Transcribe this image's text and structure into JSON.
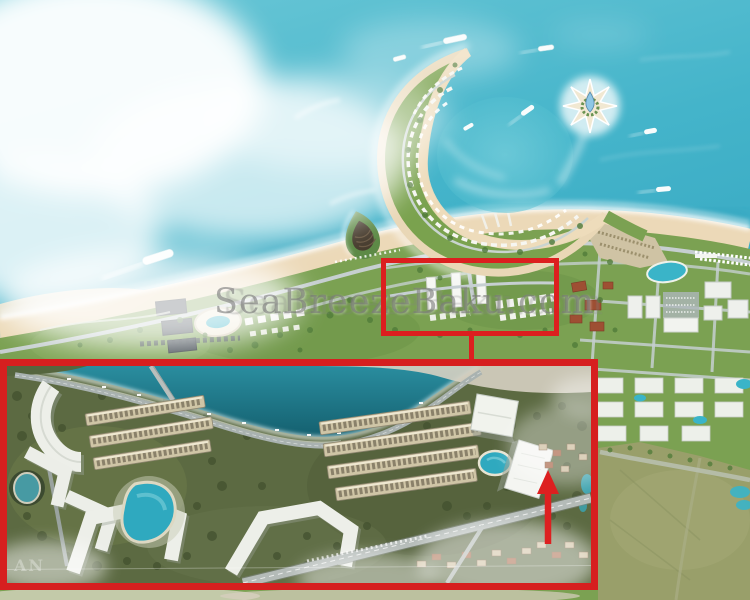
{
  "image": {
    "description": "Aerial rendering of the SeaBreeze Baku seaside resort masterplan with a crescent-shaped artificial island, a star-shaped island, beach, residential districts and a zoom inset of the highlighted coastal block",
    "watermark": {
      "text": "SeaBreezeBaku.com",
      "color": "#767676"
    },
    "annotations": {
      "highlight_box": {
        "color": "#dc1f1f",
        "purpose": "marks the coastal block that is enlarged in the inset"
      },
      "connector_line": {
        "color": "#dc1f1f"
      },
      "inset": {
        "border_color": "#d61f1f",
        "purpose": "enlarged aerial view of the highlighted coastal block",
        "watermark_fragment": "AN",
        "arrow": {
          "color": "#dd2020",
          "direction": "up",
          "target": "white residential tower"
        }
      }
    },
    "scene": {
      "sea_color": "#3fb3c9",
      "land_color": "#7ba152",
      "beach_color": "#ecd9b8",
      "pool_color": "#3ab4c8",
      "features": [
        "clouds over sea",
        "crescent-shaped island with landscaped resort",
        "eight-pointed star island with blue glass tower",
        "yachts and boats with wakes",
        "sandy beach along the coast",
        "amphitheater mound at the causeway",
        "dense beach village and lagoon pool",
        "grid of white apartment blocks",
        "open green field",
        "inset: marina waterfront, terraced townhouse rows, lagoon pools, white angular apartment buildings, highway"
      ]
    }
  }
}
